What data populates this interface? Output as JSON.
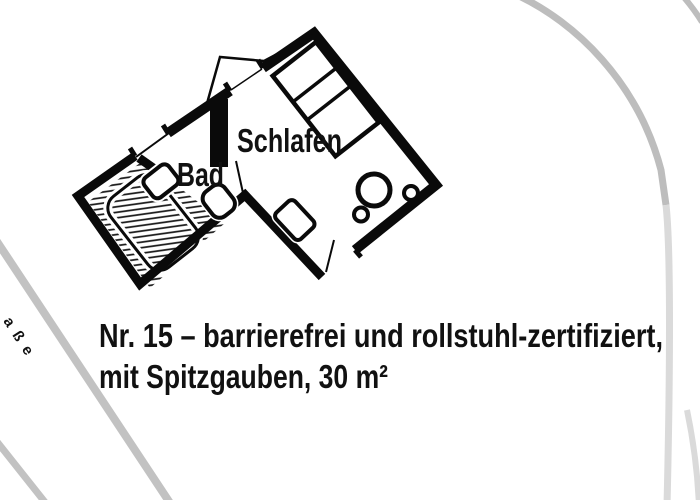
{
  "floor_plan": {
    "labels": {
      "schlafen": "Schlafen",
      "bad": "Bad"
    },
    "fixtures": [
      "shower-area",
      "shower-tray",
      "washbasin",
      "toilet",
      "hall-cabinet",
      "bed",
      "round-table",
      "stool",
      "stool",
      "entrance-door",
      "bath-door",
      "dormer",
      "window"
    ]
  },
  "caption": {
    "line1": "Nr. 15 – barrierefrei und rollstuhl-zertifiziert,",
    "line2": "mit Spitzgauben, 30 m²"
  },
  "map": {
    "street_label": "aße"
  },
  "colors": {
    "background": "#ffffff",
    "wall": "#0a0a0a",
    "text": "#111111",
    "street": "#c2c2c2",
    "street_light": "#dadada",
    "street_label": "#a9a9a9"
  }
}
